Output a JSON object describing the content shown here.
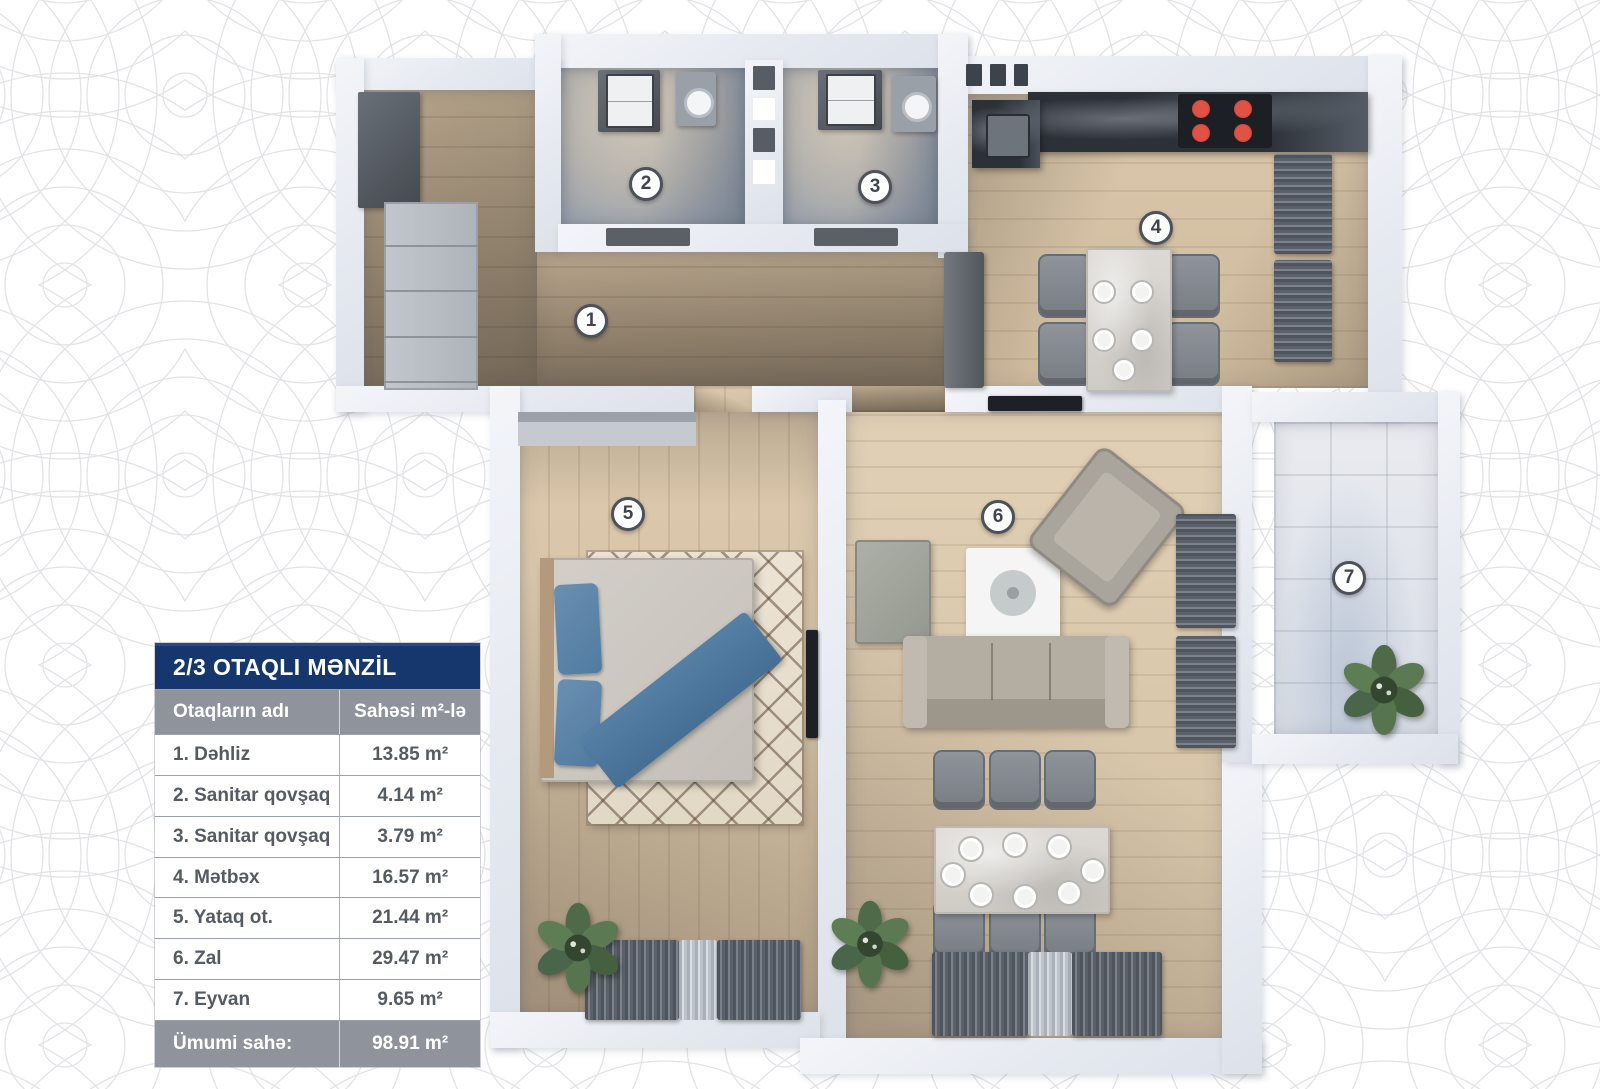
{
  "legend": {
    "title": "2/3 OTAQLI MƏNZİL",
    "header": {
      "name": "Otaqların adı",
      "area": "Sahəsi m²-lə"
    },
    "rows": [
      {
        "name": "1. Dəhliz",
        "area": "13.85 m²"
      },
      {
        "name": "2. Sanitar qovşaq",
        "area": "4.14 m²"
      },
      {
        "name": "3. Sanitar qovşaq",
        "area": "3.79 m²"
      },
      {
        "name": "4. Mətbəx",
        "area": "16.57 m²"
      },
      {
        "name": "5. Yataq ot.",
        "area": "21.44 m²"
      },
      {
        "name": "6. Zal",
        "area": "29.47 m²"
      },
      {
        "name": "7. Eyvan",
        "area": "9.65 m²"
      }
    ],
    "footer": {
      "label": "Ümumi sahə:",
      "value": "98.91 m²"
    },
    "colors": {
      "title_bg": "#16376e",
      "header_bg": "#8e939c",
      "row_text": "#565b63"
    }
  },
  "plan": {
    "badges": [
      "1",
      "2",
      "3",
      "4",
      "5",
      "6",
      "7"
    ],
    "colors": {
      "wall": "#e8ecf2",
      "wood_floor": "#d5c2a5",
      "stove_burner": "#c23c34",
      "bed_accent": "#507ba1",
      "curtain": "#5a616a",
      "plant": "#4e6a49",
      "background_pattern": "#e2e3e7"
    }
  }
}
